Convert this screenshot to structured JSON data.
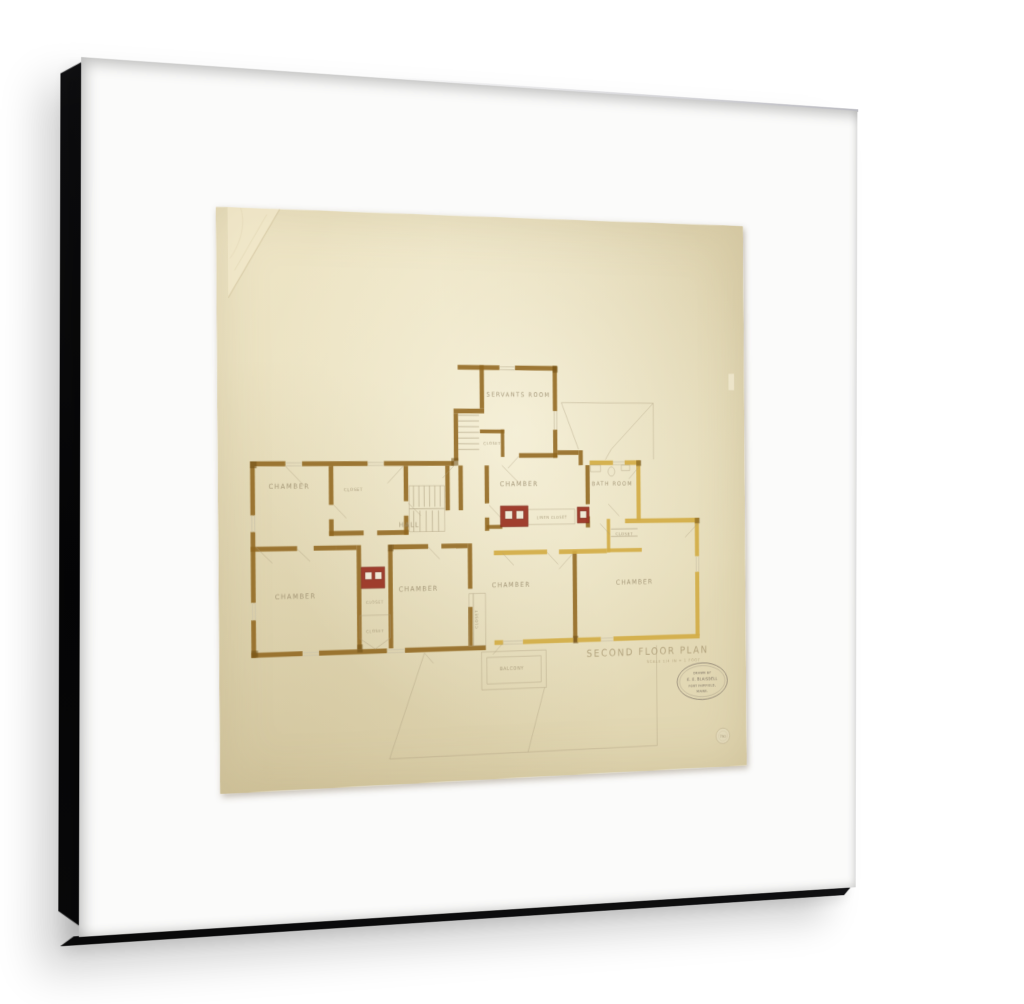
{
  "artwork": {
    "type_note": "framed architectural drawing, second floor plan, ink and watercolor on aged paper",
    "plan": {
      "title": "SECOND FLOOR PLAN",
      "scale_note": "SCALE 1/4 IN = 1 FOOT",
      "labels": [
        "SERVANTS ROOM",
        "CLOSET",
        "CHAMBER",
        "CLOSET",
        "HALL",
        "CHAMBER",
        "BATH ROOM",
        "LINEN CLOSET",
        "CLOSET",
        "CHAMBER",
        "CLOSET",
        "CLOSET",
        "CHAMBER",
        "CLOSET",
        "CHAMBER",
        "CHAMBER",
        "BALCONY"
      ]
    },
    "stamp": {
      "line1": "DRAWN BY",
      "line2": "E. E. BLAISDELL",
      "line3": "FORT FAIRFIELD,",
      "line4": "MAINE."
    },
    "seal_number": "790",
    "colors": {
      "frame": "#1b1b1d",
      "mat": "#fbfbfa",
      "paper": "#e8deba",
      "ink_brown": "#91671f",
      "ink_gold": "#d2ac45",
      "chimney_red": "#9c3526",
      "pencil": "#a99b7d",
      "label_ink": "#9b8d6e"
    }
  }
}
